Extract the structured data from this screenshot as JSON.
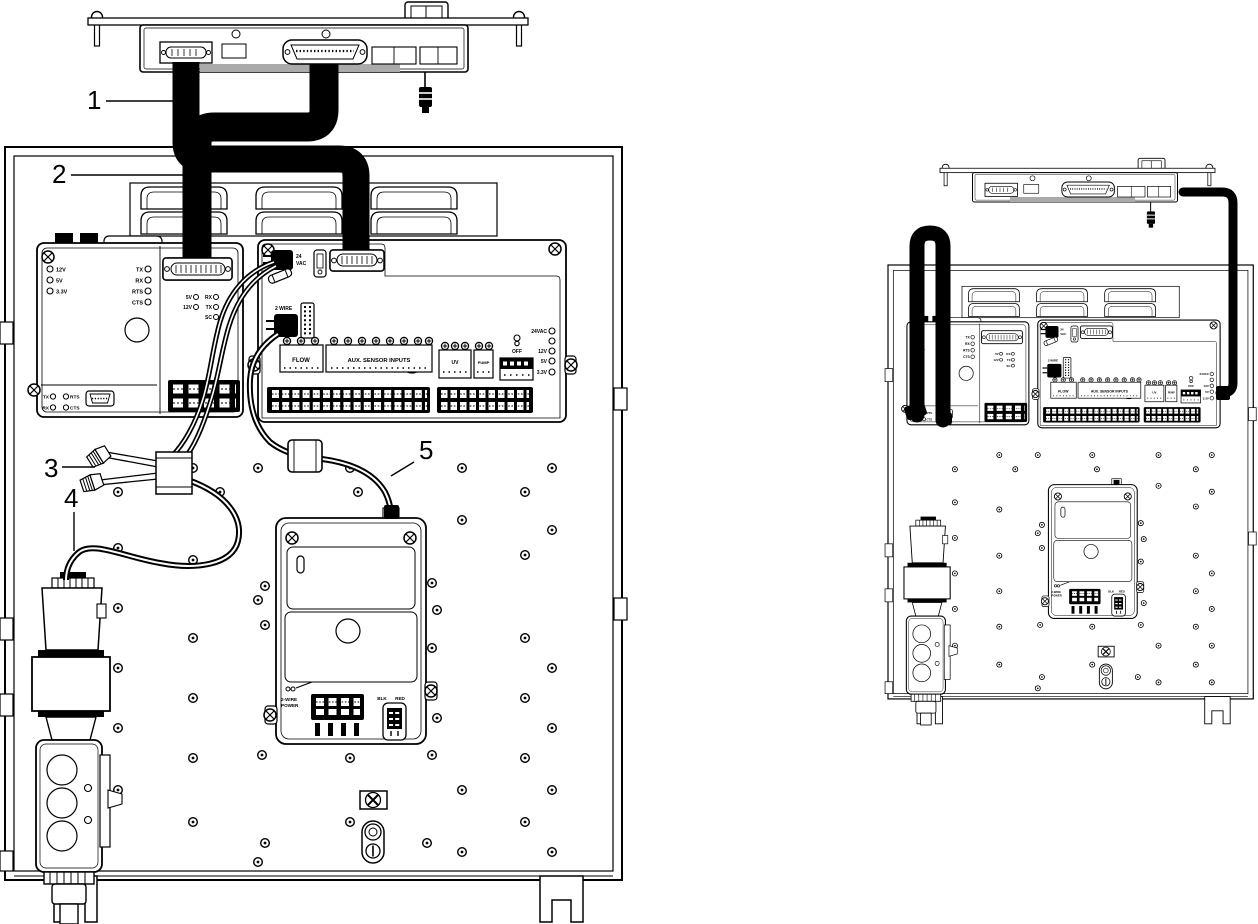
{
  "figure": {
    "description_left": "Controller display with ribbon cables wired into equipment enclosure",
    "description_right": "Enclosure with cables routed externally"
  },
  "callouts": {
    "c1": "1",
    "c2": "2",
    "c3": "3",
    "c4": "4",
    "c5": "5"
  },
  "comm_board": {
    "power_leds": [
      "12V",
      "5V",
      "3.3V"
    ],
    "serial_leds": [
      "TX",
      "RX",
      "RTS",
      "CTS"
    ],
    "bottom_left_leds": [
      "TX",
      "RX"
    ],
    "bottom_right_leds": [
      "RTS",
      "CTS"
    ],
    "radio_leds": [
      "5V",
      "RX",
      "12V",
      "TX",
      "SC"
    ]
  },
  "main_board": {
    "conn_24vac_l1": "24",
    "conn_24vac_l2": "VAC",
    "conn_2wire": "2 WIRE",
    "terminal_flow": "FLOW",
    "terminal_aux": "AUX. SENSOR INPUTS",
    "terminal_uv": "UV",
    "terminal_pump": "PUMP",
    "off_label": "OFF",
    "right_leds": [
      "24VAC",
      "12V",
      "5V",
      "3.3V"
    ]
  },
  "power_module": {
    "label_l1": "2-WIRE",
    "label_l2": "POWER",
    "blk": "BLK",
    "red": "RED"
  },
  "colors": {
    "line": "#000000",
    "background": "#ffffff",
    "shade": "#aaaaaa"
  }
}
